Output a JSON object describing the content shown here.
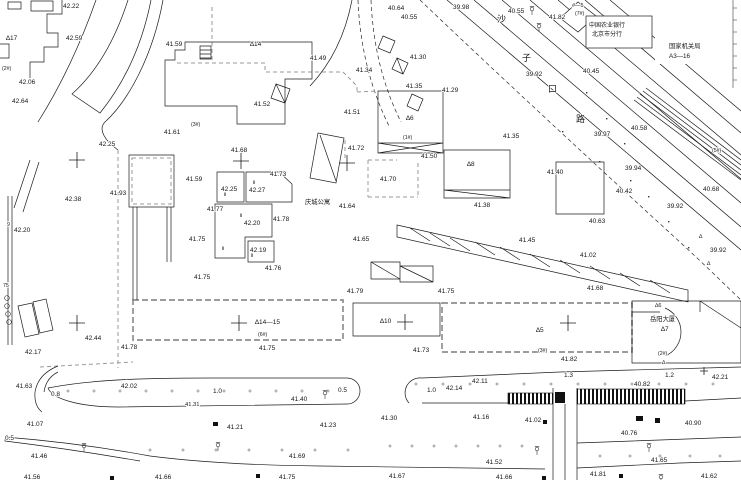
{
  "drawing": {
    "type": "surveyed cadastral site plan",
    "road_name": "沙子口路",
    "bank_box": {
      "line1": "中国农业银行",
      "line2": "北京市分行"
    },
    "agency_box": {
      "line1": "国家机关局",
      "line2": "A3—16"
    },
    "apartment_name": "庆城公寓",
    "tower_name": "岳阳大厦"
  },
  "road_name_chars": [
    {
      "t": "沙",
      "x": 497,
      "y": 22
    },
    {
      "t": "子",
      "x": 522,
      "y": 61
    },
    {
      "t": "口",
      "x": 548,
      "y": 92
    },
    {
      "t": "路",
      "x": 576,
      "y": 122
    }
  ],
  "annotations": [
    {
      "t": "42.22",
      "x": 63,
      "y": 8
    },
    {
      "t": "40.64",
      "x": 388,
      "y": 10
    },
    {
      "t": "40.55",
      "x": 401,
      "y": 19
    },
    {
      "t": "39.98",
      "x": 453,
      "y": 9
    },
    {
      "t": "40.55",
      "x": 508,
      "y": 13
    },
    {
      "t": "41.82",
      "x": 549,
      "y": 19
    },
    {
      "t": "#—5",
      "x": 572,
      "y": 7,
      "s": 5.5
    },
    {
      "t": "(7#)",
      "x": 575,
      "y": 15,
      "s": 5.2
    },
    {
      "t": "中国农业银行",
      "x": 589,
      "y": 27,
      "s": 6
    },
    {
      "t": "北京市分行",
      "x": 592,
      "y": 36,
      "s": 6
    },
    {
      "t": "国家机关局",
      "x": 669,
      "y": 48,
      "s": 6.3
    },
    {
      "t": "A3—16",
      "x": 669,
      "y": 58,
      "s": 6.3
    },
    {
      "t": "42.59",
      "x": 66,
      "y": 40
    },
    {
      "t": "41.59",
      "x": 166,
      "y": 46
    },
    {
      "t": "∆17",
      "x": 6,
      "y": 40
    },
    {
      "t": "∆14",
      "x": 250,
      "y": 46
    },
    {
      "t": "41.49",
      "x": 310,
      "y": 60
    },
    {
      "t": "41.34",
      "x": 356,
      "y": 72
    },
    {
      "t": "41.30",
      "x": 410,
      "y": 59
    },
    {
      "t": "41.35",
      "x": 406,
      "y": 88
    },
    {
      "t": "41.29",
      "x": 442,
      "y": 92
    },
    {
      "t": "39.92",
      "x": 526,
      "y": 76
    },
    {
      "t": "40.45",
      "x": 583,
      "y": 73
    },
    {
      "t": "(2#)",
      "x": 2,
      "y": 70,
      "s": 5.2
    },
    {
      "t": "42.06",
      "x": 19,
      "y": 84
    },
    {
      "t": "42.64",
      "x": 12,
      "y": 103
    },
    {
      "t": "41.52",
      "x": 254,
      "y": 106
    },
    {
      "t": "41.51",
      "x": 344,
      "y": 114
    },
    {
      "t": "(3#)",
      "x": 191,
      "y": 126,
      "s": 5.2
    },
    {
      "t": "41.61",
      "x": 164,
      "y": 134
    },
    {
      "t": "42.25",
      "x": 99,
      "y": 146
    },
    {
      "t": "41.68",
      "x": 231,
      "y": 152
    },
    {
      "t": "40.58",
      "x": 631,
      "y": 130
    },
    {
      "t": "39.97",
      "x": 594,
      "y": 136
    },
    {
      "t": "(5#)",
      "x": 712,
      "y": 152,
      "s": 5.2
    },
    {
      "t": "41.35",
      "x": 503,
      "y": 138
    },
    {
      "t": "41.72",
      "x": 348,
      "y": 150
    },
    {
      "t": "41.50",
      "x": 421,
      "y": 158
    },
    {
      "t": "∆6",
      "x": 406,
      "y": 120
    },
    {
      "t": "(1#)",
      "x": 403,
      "y": 139,
      "s": 5.2
    },
    {
      "t": "∆8",
      "x": 467,
      "y": 166
    },
    {
      "t": "41.40",
      "x": 547,
      "y": 174
    },
    {
      "t": "39.94",
      "x": 625,
      "y": 170
    },
    {
      "t": "40.42",
      "x": 616,
      "y": 193
    },
    {
      "t": "40.68",
      "x": 703,
      "y": 191
    },
    {
      "t": "39.92",
      "x": 667,
      "y": 208
    },
    {
      "t": "41.93",
      "x": 110,
      "y": 195
    },
    {
      "t": "42.38",
      "x": 65,
      "y": 201
    },
    {
      "t": "42.20",
      "x": 14,
      "y": 232
    },
    {
      "t": "9",
      "x": 7,
      "y": 226,
      "s": 5.2
    },
    {
      "t": "75",
      "x": 3,
      "y": 287,
      "s": 5.2
    },
    {
      "t": "41.59",
      "x": 186,
      "y": 181
    },
    {
      "t": "41.73",
      "x": 270,
      "y": 176
    },
    {
      "t": "42.25",
      "x": 221,
      "y": 191
    },
    {
      "t": "42.27",
      "x": 249,
      "y": 192
    },
    {
      "t": "41.77",
      "x": 207,
      "y": 211
    },
    {
      "t": "42.20",
      "x": 244,
      "y": 225
    },
    {
      "t": "41.78",
      "x": 273,
      "y": 221
    },
    {
      "t": "41.75",
      "x": 189,
      "y": 241
    },
    {
      "t": "42.19",
      "x": 250,
      "y": 252
    },
    {
      "t": "41.76",
      "x": 265,
      "y": 270
    },
    {
      "t": "41.75",
      "x": 194,
      "y": 279
    },
    {
      "t": "41.70",
      "x": 380,
      "y": 181
    },
    {
      "t": "庆城公寓",
      "x": 305,
      "y": 204,
      "s": 6.3
    },
    {
      "t": "41.64",
      "x": 339,
      "y": 208
    },
    {
      "t": "41.65",
      "x": 353,
      "y": 241
    },
    {
      "t": "41.38",
      "x": 474,
      "y": 207
    },
    {
      "t": "41.45",
      "x": 519,
      "y": 242
    },
    {
      "t": "40.63",
      "x": 589,
      "y": 223
    },
    {
      "t": "41.02",
      "x": 580,
      "y": 257
    },
    {
      "t": "39.92",
      "x": 710,
      "y": 252
    },
    {
      "t": "41.68",
      "x": 587,
      "y": 290
    },
    {
      "t": "41.79",
      "x": 347,
      "y": 293
    },
    {
      "t": "41.75",
      "x": 438,
      "y": 293
    },
    {
      "t": "∆14—15",
      "x": 255,
      "y": 324
    },
    {
      "t": "(6#)",
      "x": 258,
      "y": 336,
      "s": 5.2
    },
    {
      "t": "41.75",
      "x": 259,
      "y": 350
    },
    {
      "t": "∆10",
      "x": 380,
      "y": 323
    },
    {
      "t": "41.73",
      "x": 413,
      "y": 352
    },
    {
      "t": "∆5",
      "x": 536,
      "y": 332
    },
    {
      "t": "(3#)",
      "x": 538,
      "y": 352,
      "s": 5.2
    },
    {
      "t": "41.82",
      "x": 561,
      "y": 361
    },
    {
      "t": "∆6",
      "x": 655,
      "y": 307,
      "s": 5.5
    },
    {
      "t": "岳阳大厦",
      "x": 650,
      "y": 321,
      "s": 6.3
    },
    {
      "t": "∆7",
      "x": 661,
      "y": 331
    },
    {
      "t": "(2#)",
      "x": 658,
      "y": 355,
      "s": 5.2
    },
    {
      "t": "∆",
      "x": 662,
      "y": 364,
      "s": 5.5
    },
    {
      "t": "∆",
      "x": 699,
      "y": 238,
      "s": 5.5
    },
    {
      "t": "∆",
      "x": 707,
      "y": 265,
      "s": 5.5
    },
    {
      "t": "42.17",
      "x": 25,
      "y": 354
    },
    {
      "t": "42.44",
      "x": 85,
      "y": 340
    },
    {
      "t": "41.78",
      "x": 121,
      "y": 349
    },
    {
      "t": "41.63",
      "x": 16,
      "y": 388
    },
    {
      "t": "42.02",
      "x": 121,
      "y": 388
    },
    {
      "t": "0.8",
      "x": 51,
      "y": 396
    },
    {
      "t": "1.0",
      "x": 213,
      "y": 393
    },
    {
      "t": "41.31",
      "x": 185,
      "y": 406,
      "s": 5.8
    },
    {
      "t": "0.5",
      "x": 338,
      "y": 392
    },
    {
      "t": "41.40",
      "x": 291,
      "y": 401
    },
    {
      "t": "1.0",
      "x": 427,
      "y": 392
    },
    {
      "t": "42.14",
      "x": 446,
      "y": 390
    },
    {
      "t": "42.11",
      "x": 472,
      "y": 383
    },
    {
      "t": "1.3",
      "x": 564,
      "y": 377
    },
    {
      "t": "1.2",
      "x": 665,
      "y": 377
    },
    {
      "t": "42.21",
      "x": 712,
      "y": 379
    },
    {
      "t": "40.82",
      "x": 634,
      "y": 386
    },
    {
      "t": "41.07",
      "x": 27,
      "y": 426
    },
    {
      "t": "41.21",
      "x": 227,
      "y": 429
    },
    {
      "t": "41.23",
      "x": 320,
      "y": 427
    },
    {
      "t": "41.30",
      "x": 381,
      "y": 420
    },
    {
      "t": "41.16",
      "x": 473,
      "y": 419
    },
    {
      "t": "41.02",
      "x": 525,
      "y": 422
    },
    {
      "t": "40.90",
      "x": 685,
      "y": 425
    },
    {
      "t": "40.76",
      "x": 621,
      "y": 435
    },
    {
      "t": "0.5",
      "x": 5,
      "y": 440
    },
    {
      "t": "41.46",
      "x": 31,
      "y": 458
    },
    {
      "t": "41.69",
      "x": 289,
      "y": 458
    },
    {
      "t": "41.52",
      "x": 486,
      "y": 464
    },
    {
      "t": "41.65",
      "x": 651,
      "y": 462
    },
    {
      "t": "41.56",
      "x": 24,
      "y": 479
    },
    {
      "t": "41.66",
      "x": 155,
      "y": 479
    },
    {
      "t": "41.75",
      "x": 279,
      "y": 479
    },
    {
      "t": "41.67",
      "x": 389,
      "y": 478
    },
    {
      "t": "41.66",
      "x": 496,
      "y": 479
    },
    {
      "t": "41.81",
      "x": 590,
      "y": 476
    },
    {
      "t": "41.62",
      "x": 701,
      "y": 478
    },
    {
      "t": "Ⅱ",
      "x": 224,
      "y": 196,
      "s": 5
    },
    {
      "t": "Ⅱ",
      "x": 253,
      "y": 184,
      "s": 5
    },
    {
      "t": "Ⅱ",
      "x": 240,
      "y": 217,
      "s": 5
    },
    {
      "t": "Ⅱ",
      "x": 222,
      "y": 250,
      "s": 5
    },
    {
      "t": "Ⅱ",
      "x": 251,
      "y": 257,
      "s": 5
    }
  ],
  "crosses": [
    [
      77,
      160
    ],
    [
      241,
      161
    ],
    [
      77,
      323
    ],
    [
      239,
      323
    ],
    [
      405,
      322
    ],
    [
      568,
      323
    ],
    [
      347,
      163
    ],
    [
      704,
      371
    ]
  ],
  "trees": [
    [
      532,
      9
    ],
    [
      539,
      26
    ],
    [
      84,
      446
    ],
    [
      218,
      445
    ],
    [
      537,
      449
    ],
    [
      649,
      446
    ],
    [
      325,
      393
    ],
    [
      661,
      477
    ]
  ],
  "diag_dots": [
    [
      586,
      92
    ],
    [
      606,
      118
    ],
    [
      624,
      143
    ],
    [
      562,
      131
    ],
    [
      599,
      161
    ],
    [
      648,
      196
    ],
    [
      668,
      221
    ],
    [
      688,
      247
    ],
    [
      630,
      180
    ]
  ]
}
